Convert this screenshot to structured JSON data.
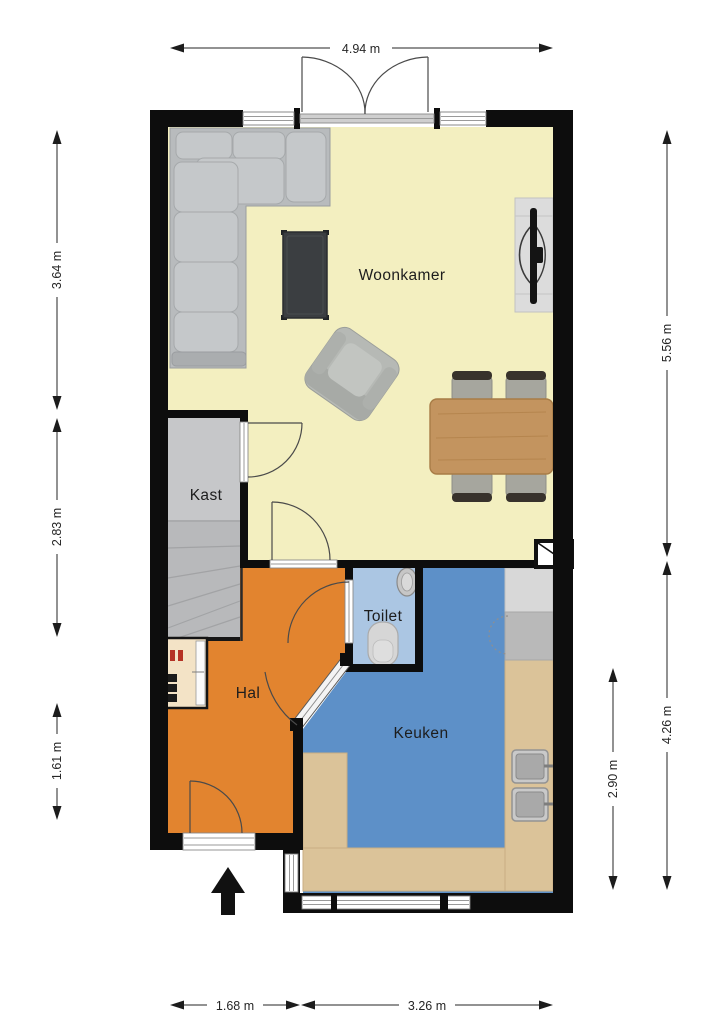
{
  "plan": {
    "rooms": {
      "woonkamer": "Woonkamer",
      "kast": "Kast",
      "toilet": "Toilet",
      "hal": "Hal",
      "keuken": "Keuken"
    },
    "dimensions": {
      "top": "4.94 m",
      "left": [
        "3.64 m",
        "2.83 m",
        "1.61 m"
      ],
      "right": [
        "5.56 m",
        "4.26 m"
      ],
      "right_inner": "2.90 m",
      "bottom": [
        "1.68 m",
        "3.26 m"
      ]
    },
    "colors": {
      "woonkamer": "#f3efc0",
      "hal": "#e2842f",
      "keuken": "#5d90c8",
      "toilet": "#abc6e3",
      "kast": "#c6c7c9",
      "stairs": "#b8b9bb",
      "counter": "#dbc399",
      "table_wood": "#c3945f",
      "wall": "#0d0d0d"
    },
    "furniture": [
      "corner-sofa",
      "coffee-table",
      "armchair",
      "tv-cabinet",
      "dining-table",
      "dining-chairs",
      "staircase",
      "hall-cabinet",
      "toilet-bowl",
      "hand-basin",
      "fridge",
      "washing-machine",
      "kitchen-sinks",
      "kitchen-counter",
      "french-doors",
      "entrance-arrow"
    ]
  }
}
